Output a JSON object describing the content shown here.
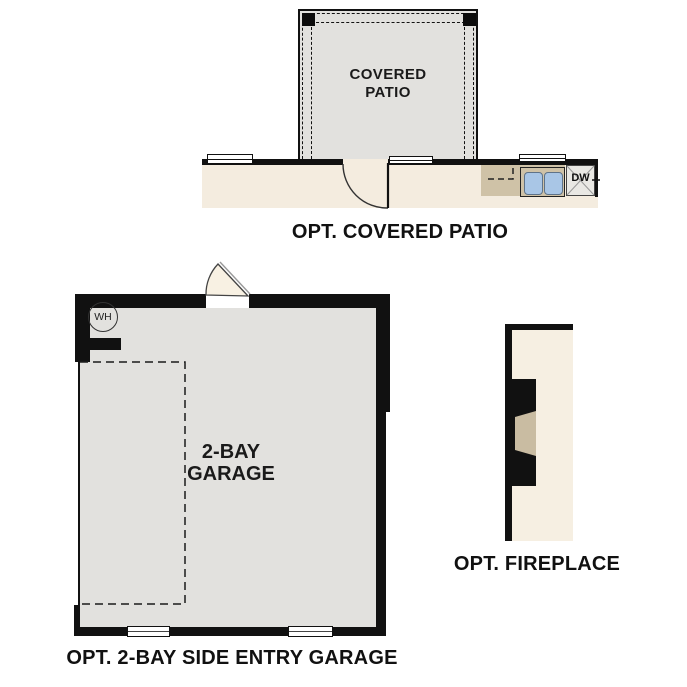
{
  "plans": {
    "covered_patio": {
      "room_label_line1": "COVERED",
      "room_label_line2": "PATIO",
      "caption": "OPT. COVERED PATIO",
      "dishwasher_label": "DW"
    },
    "garage": {
      "water_heater_label": "WH",
      "room_label_line1": "2-BAY",
      "room_label_line2": "GARAGE",
      "caption": "OPT. 2-BAY SIDE ENTRY GARAGE"
    },
    "fireplace": {
      "caption": "OPT. FIREPLACE"
    }
  },
  "colors": {
    "wall_black": "#111111",
    "floor_gray": "#e2e1de",
    "interior_beige": "#f4ecdf",
    "counter_tan": "#cfc2a7",
    "sink_blue": "#a9c6e6",
    "dishwasher_gray": "#e9e8e4",
    "door_leaf_beige": "#f8f1e3",
    "fireplace_beige": "#f6efe2",
    "hearth_tan": "#c9bca2"
  }
}
